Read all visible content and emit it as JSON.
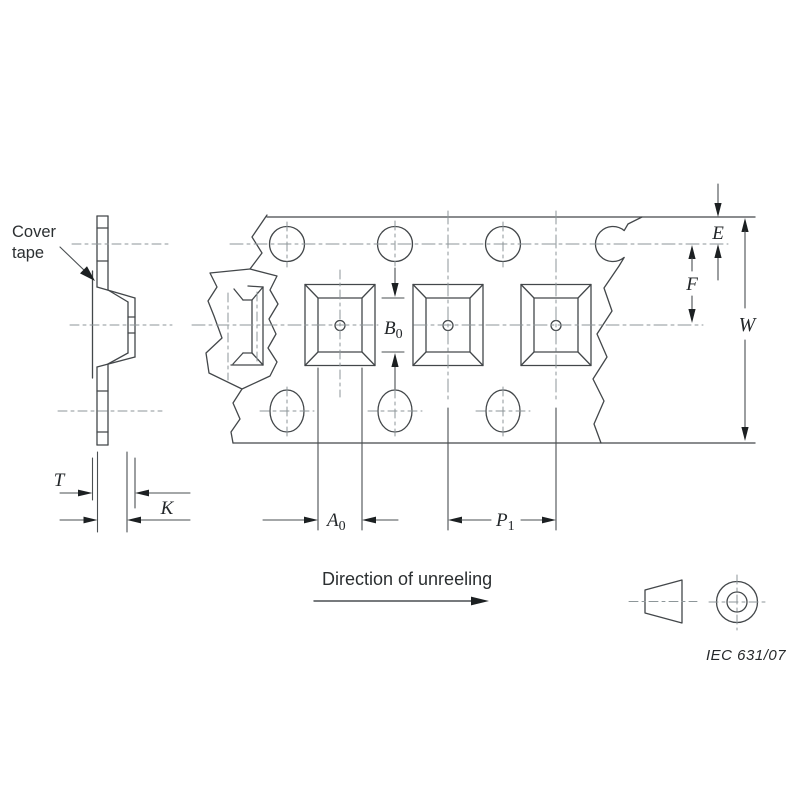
{
  "figure": {
    "description": "IEC carrier tape dimensioning drawing (embossed tape, top view and section)",
    "reference": "IEC  631/07",
    "direction_label": "Direction of unreeling",
    "cover_tape_label": {
      "line1": "Cover",
      "line2": "tape"
    }
  },
  "dimensions": {
    "T": {
      "base": "T"
    },
    "K": {
      "base": "K"
    },
    "E": {
      "base": "E"
    },
    "F": {
      "base": "F"
    },
    "W": {
      "base": "W"
    },
    "B0": {
      "base": "B",
      "sub": "0"
    },
    "A0": {
      "base": "A",
      "sub": "0"
    },
    "P1": {
      "base": "P",
      "sub": "1"
    }
  },
  "colors": {
    "background": "#ffffff",
    "outline": "#43474a",
    "centerline": "#8d9699",
    "arrow_and_text": "#1c2022"
  }
}
